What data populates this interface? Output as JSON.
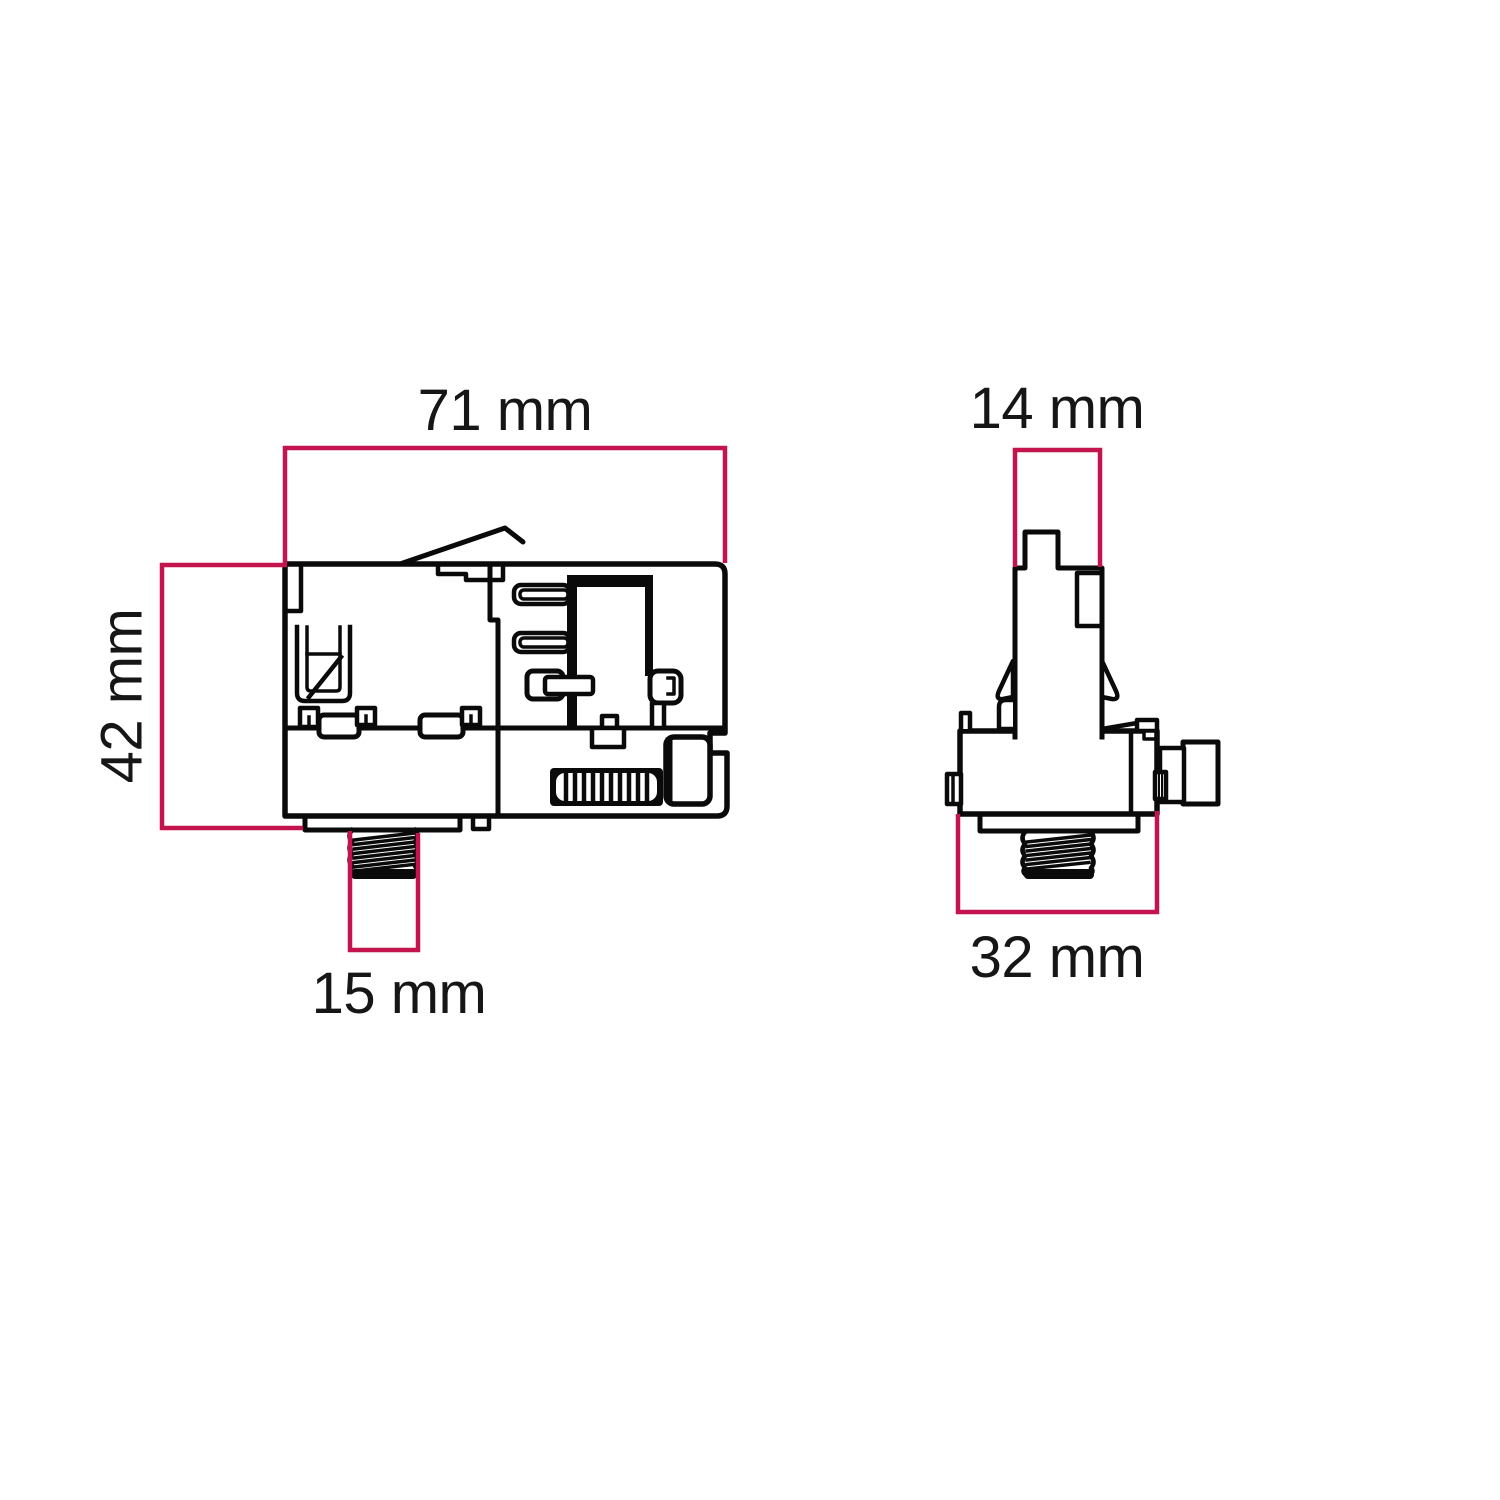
{
  "colors": {
    "dimension_line": "#c3144e",
    "drawing_line": "#0a0a0a",
    "background": "#ffffff"
  },
  "views": {
    "side_view": {
      "name": "track adapter side view",
      "dimensions": {
        "width": {
          "label": "71 mm"
        },
        "height": {
          "label": "42 mm"
        },
        "thread": {
          "label": "15 mm"
        }
      }
    },
    "end_view": {
      "name": "track adapter end view",
      "dimensions": {
        "top_width": {
          "label": "14 mm"
        },
        "body_width": {
          "label": "32 mm"
        }
      }
    }
  }
}
